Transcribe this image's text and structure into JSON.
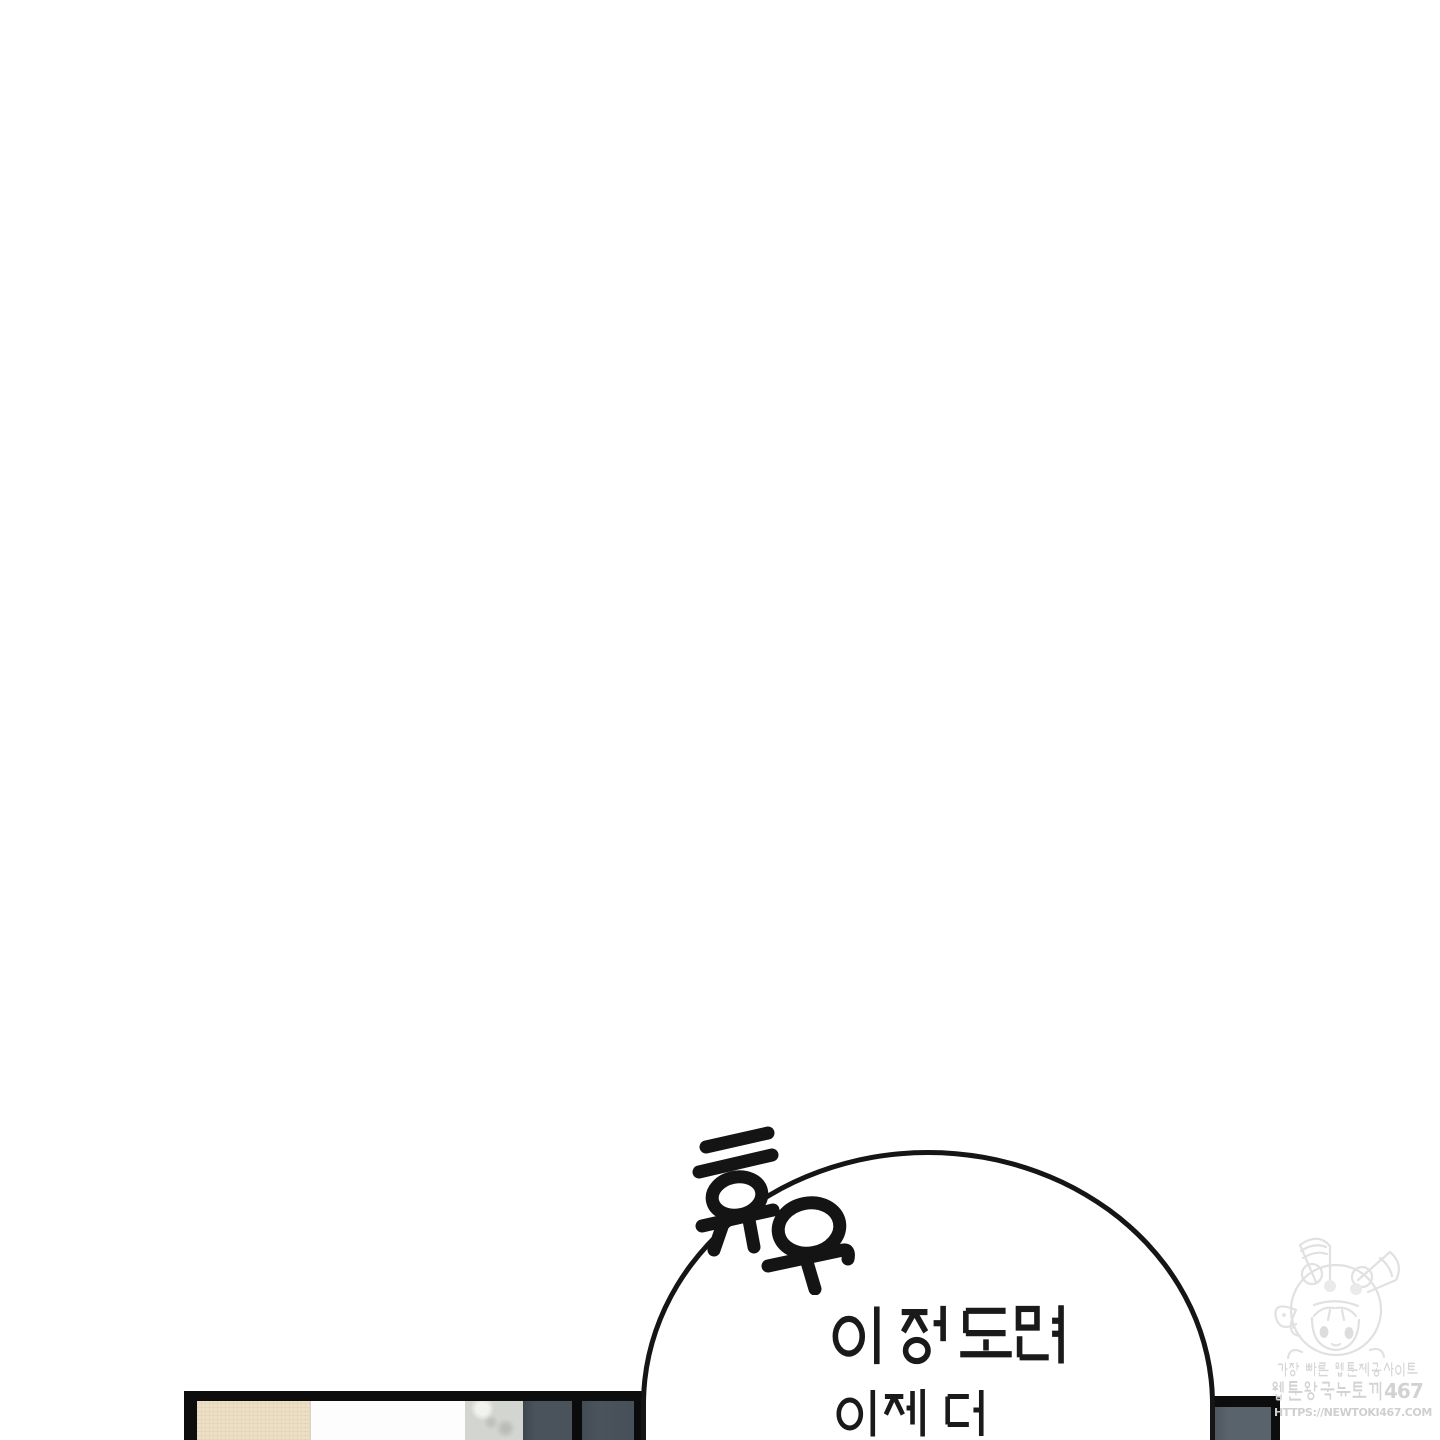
{
  "page": {
    "type": "webtoon-panel",
    "background": "#ffffff"
  },
  "sfx": {
    "text": "휴우",
    "style": "hand-drawn-bold",
    "color": "#141414"
  },
  "speech_bubble": {
    "lines": [
      "이 정도면",
      "이제 더"
    ],
    "fill": "#ffffff",
    "outline_color": "#151515"
  },
  "scene": {
    "left_cabinet": {
      "panels": [
        "beige",
        "white",
        "marble",
        "dark-slate",
        "dark-slate"
      ],
      "colors": {
        "beige": "#ecdfc5",
        "white": "#fdfdfd",
        "marble": "#d3d5d0",
        "slate": "#4a525b",
        "outline": "#0d0d0d"
      }
    },
    "right_cabinet": {
      "colors": {
        "slate": "#59636c",
        "outline": "#0d0d0d"
      }
    }
  },
  "watermark": {
    "line1": "가장 빠른 웹툰제공사이트",
    "line2": "웹툰왕국뉴토끼467",
    "line2_digits": "467",
    "line3": "HTTPS://NEWTOKI467.COM",
    "color": "#d6d6d6",
    "mascot": "chibi-girl-animal-hood-mascot"
  }
}
